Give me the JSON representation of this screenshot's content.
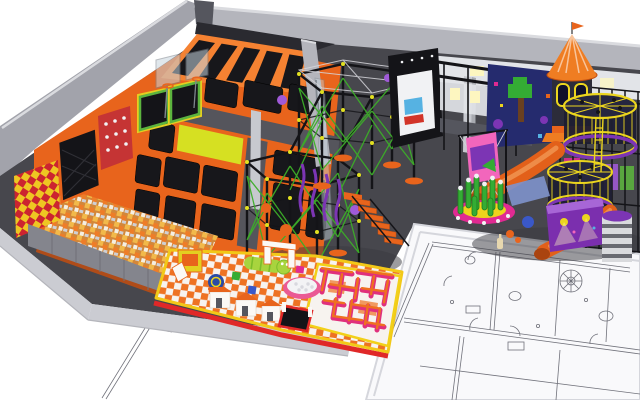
{
  "figure": {
    "kind": "3d-render",
    "subject": "indoor trampoline and adventure park concept render placed over an architectural floor plan",
    "areas": [
      "wall-trampolines",
      "main-trampoline-court",
      "airbag-pad",
      "foam-pit",
      "padded-climb-wall",
      "dodgeball-panel",
      "wall-trampoline-panel",
      "basketball-hoops",
      "safety-railing",
      "glass-divider",
      "ropes-course",
      "orange-staircase",
      "interactive-game-wall",
      "arcade-frame",
      "kids-play-structure",
      "castle-tower",
      "spiral-cage-towers",
      "tube-slides",
      "disco-room",
      "bamboo-climb",
      "striped-tower",
      "toddler-soft-play",
      "toddler-maze",
      "floor-plan-drawing"
    ]
  },
  "palette": {
    "bg": "#ffffff",
    "floor": "#47474d",
    "floorShadow": "#3a3a40",
    "skirt": "#cbccd2",
    "skirtDark": "#b4b5bb",
    "wallFace": "#b4b5bc",
    "wallLeft": "#a2a3ab",
    "wallTop": "#dadbdf",
    "wallDark": "#8d8e96",
    "lowWall": "#84858d",
    "seam": "#6f7078",
    "block": "#55565e",
    "darkStrip": "#2a2a30",
    "paper": "#f9f9fb",
    "paperEdge": "#d5d6dc",
    "planLine": "#70717a",
    "orange": "#e8641c",
    "orangeLight": "#f58232",
    "orangeDark": "#c24e10",
    "bed": "#17171b",
    "bedWeave": "#2f2f35",
    "walkway": "#55555c",
    "padYellow": "#d6e022",
    "foamBase": "#d2873a",
    "foam1": "#f2b94a",
    "foam2": "#ee7d28",
    "foam3": "#f5efe2",
    "foam4": "#cfd0d4",
    "red": "#c53434",
    "checkRed": "#cc2430",
    "checkYellow": "#eec622",
    "panelGreen": "#5cb43e",
    "panelYellow": "#e4cf20",
    "black": "#141418",
    "glass": "#c7d5de",
    "rail": "#7e858d",
    "cable": "#d5d5da",
    "netGray": "#9aa0a6",
    "rope": "#3cae28",
    "node": "#e2e020",
    "purple": "#7c35b4",
    "purpleLight": "#a05ad8",
    "white": "#f1f2f4",
    "navy": "#252b6e",
    "screenBlue": "#56b2e2",
    "screenRed": "#d23428",
    "ninjaWall": "#e2e4e8",
    "window": "#fdf6c0",
    "cone": "#ef7d22",
    "towerBody": "#2c2c3a",
    "towerWin": "#10102a",
    "cageYellow": "#ecd51e",
    "cageDark": "#1e1e32",
    "cageTop": "#262640",
    "magenta": "#e02a92",
    "pinkLight": "#f266bc",
    "tube": "#e2601a",
    "tubeHi": "#f4a05c",
    "tubeEnd": "#aa4410",
    "bamboo": "#34ac34",
    "bambooDark": "#1f7c1f",
    "matYellow": "#eed31c",
    "disco": "#7b2fae",
    "discoTop": "#a766d6",
    "blue": "#3a58c8",
    "slate": "#7e92cc",
    "trunk": "#6a4020",
    "checkA": "#ee7223",
    "checkB": "#f7f3ef",
    "mazeWallTop": "#ef7020",
    "mazeWallSide": "#e0307c",
    "mazeBorder": "#f2d018",
    "edgeYellow": "#f2c818",
    "edgeRed": "#e02828",
    "cater": "#a8d43e",
    "caterDark": "#7cbc2a",
    "ballPit": "#f3f3f5",
    "ballRim": "#ea5a94",
    "ballDot": "#d8d8de",
    "snail": "#2a4aa4",
    "houseWhite": "#fbf9f6",
    "houseTrim": "#d8c8b8",
    "bottle": "#e7d7ae",
    "column": "#c7c9cf",
    "columnShade": "#a8aab0",
    "cylGray": "#d9dadd"
  }
}
